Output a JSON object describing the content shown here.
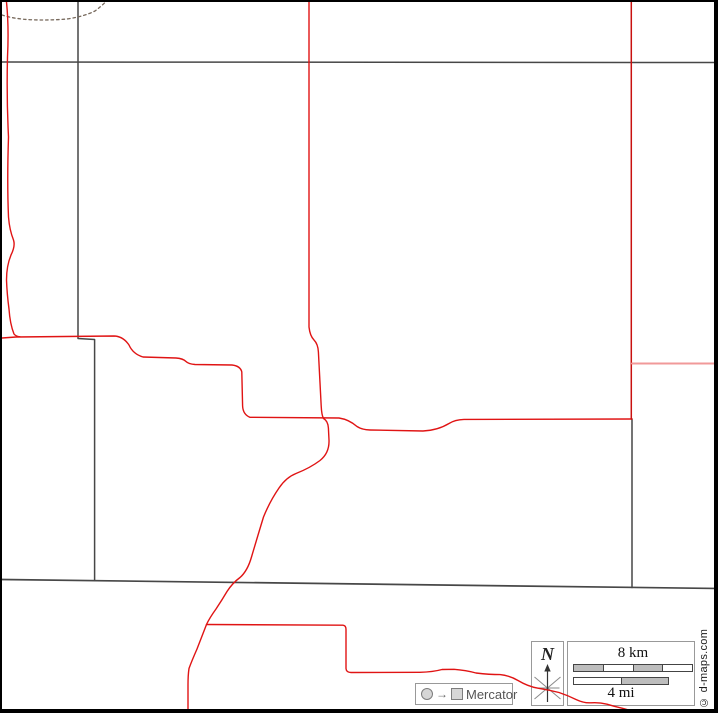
{
  "map": {
    "compass": {
      "label": "N"
    },
    "scale": {
      "km_label": "8 km",
      "mi_label": "4 mi",
      "km_segments": [
        "gray",
        "white",
        "gray",
        "white"
      ],
      "mi_segments": [
        "white",
        "gray"
      ]
    },
    "projection": {
      "arrow": "→",
      "label": "Mercator"
    },
    "credit": "© d-maps.com",
    "colors": {
      "boundary": "#474747",
      "road_red": "#e01414",
      "road_dark_red": "#c9100f",
      "road_light_red": "#f19999",
      "stream_brown": "#77695c",
      "bar_gray": "#bdbdbd",
      "bar_white": "#ffffff"
    },
    "lines": [
      {
        "name": "boundary-top",
        "color": "#474747",
        "width": 1.5,
        "dash": "",
        "d": "M0,60 L718,60.5"
      },
      {
        "name": "boundary-west",
        "color": "#474747",
        "width": 1.5,
        "dash": "",
        "d": "M76,0 L76,336.5 L92.6,337.5 L92.6,578.5"
      },
      {
        "name": "boundary-mid",
        "color": "#474747",
        "width": 1.7,
        "dash": "",
        "d": "M0,577.5 L718,586.5"
      },
      {
        "name": "boundary-east",
        "color": "#474747",
        "width": 1.5,
        "dash": "",
        "d": "M630,417 L630,585.5"
      },
      {
        "name": "stream-dotted",
        "color": "#77695c",
        "width": 1.3,
        "dash": "2.5 3",
        "d": "M0,13 Q12,17 30,17.8 Q48,18.4 65,17 Q82,14.5 93,9 Q99,4.5 103.5,0"
      },
      {
        "name": "road-west-vertical",
        "color": "#e01414",
        "width": 1.4,
        "dash": "",
        "d": "M4.5,0 Q7,25 5.5,55 Q4.5,95 6.5,135 Q5,180 6.5,215 Q7.5,228 11.5,238 Q13.5,244 9,253 Q4.5,264 4.5,278 Q5,292 7,307 Q8,322 12,332 Q14,334.5 18,334.8"
      },
      {
        "name": "road-main",
        "color": "#e01414",
        "width": 1.4,
        "dash": "",
        "d": "M0,336 L14,335 L112,334 Q121,334.2 127,343 Q131,352 141,355 L174,356 Q181,356.5 184,359.5 Q186.5,362 193,362.5 L230,363 Q238.5,364 239.8,370 L240.6,404 Q241,412.5 248,415.3 L337,416 Q347,417.5 355,424.5 Q360,427.8 368,428 L421,429 Q436,428.2 447,421.5 Q453,417.6 462,417.4 L630,417"
      },
      {
        "name": "road-center-vertical",
        "color": "#e01414",
        "width": 1.4,
        "dash": "",
        "d": "M307,0 L307,325 Q308,334 312,338 Q316,342 316.4,350 L319.2,404 Q319.6,413 321.5,416.5 Q326,419 326.4,426 L327,438 Q327.5,451 318,458.5 Q308,466 294,471.5 Q284,475.5 277,486 Q268,499 261.5,515 Q256,533 249.5,555 Q245.5,569 238,575.5 Q230.5,581 225,589.5 Q220,598 214,607 Q207.5,616 204.5,622.5 Q200,634 195,647 Q189.5,659.5 187,666.5 Q186,673 186,683 L186,713"
      },
      {
        "name": "road-branch-southeast",
        "color": "#e01414",
        "width": 1.4,
        "dash": "",
        "d": "M204.5,622.5 L341,623.2 Q344,623.5 344,627.5 L344,666.5 Q344.2,670.3 349,670.5 L418,670.3 Q431,670 440,667.5 L452,667.3 Q464,668.2 474,671 Q488,672.6 498,672.6 Q507.5,673.5 516,678.5 Q526,684.5 536,686.2 Q547,688 557,690.5 Q566,693.5 574,697.5 Q582,701.3 589,700.8 Q597,700.2 605,702.2 Q613,704.7 620,706.2 Q629,708.7 636,710.5 L640,711.3"
      },
      {
        "name": "road-east-vertical",
        "color": "#c9100f",
        "width": 1.5,
        "dash": "",
        "d": "M629.3,0 L629.3,417"
      },
      {
        "name": "road-east-branch",
        "color": "#f19999",
        "width": 2,
        "dash": "",
        "d": "M630,361.5 L718,361.5"
      }
    ]
  }
}
